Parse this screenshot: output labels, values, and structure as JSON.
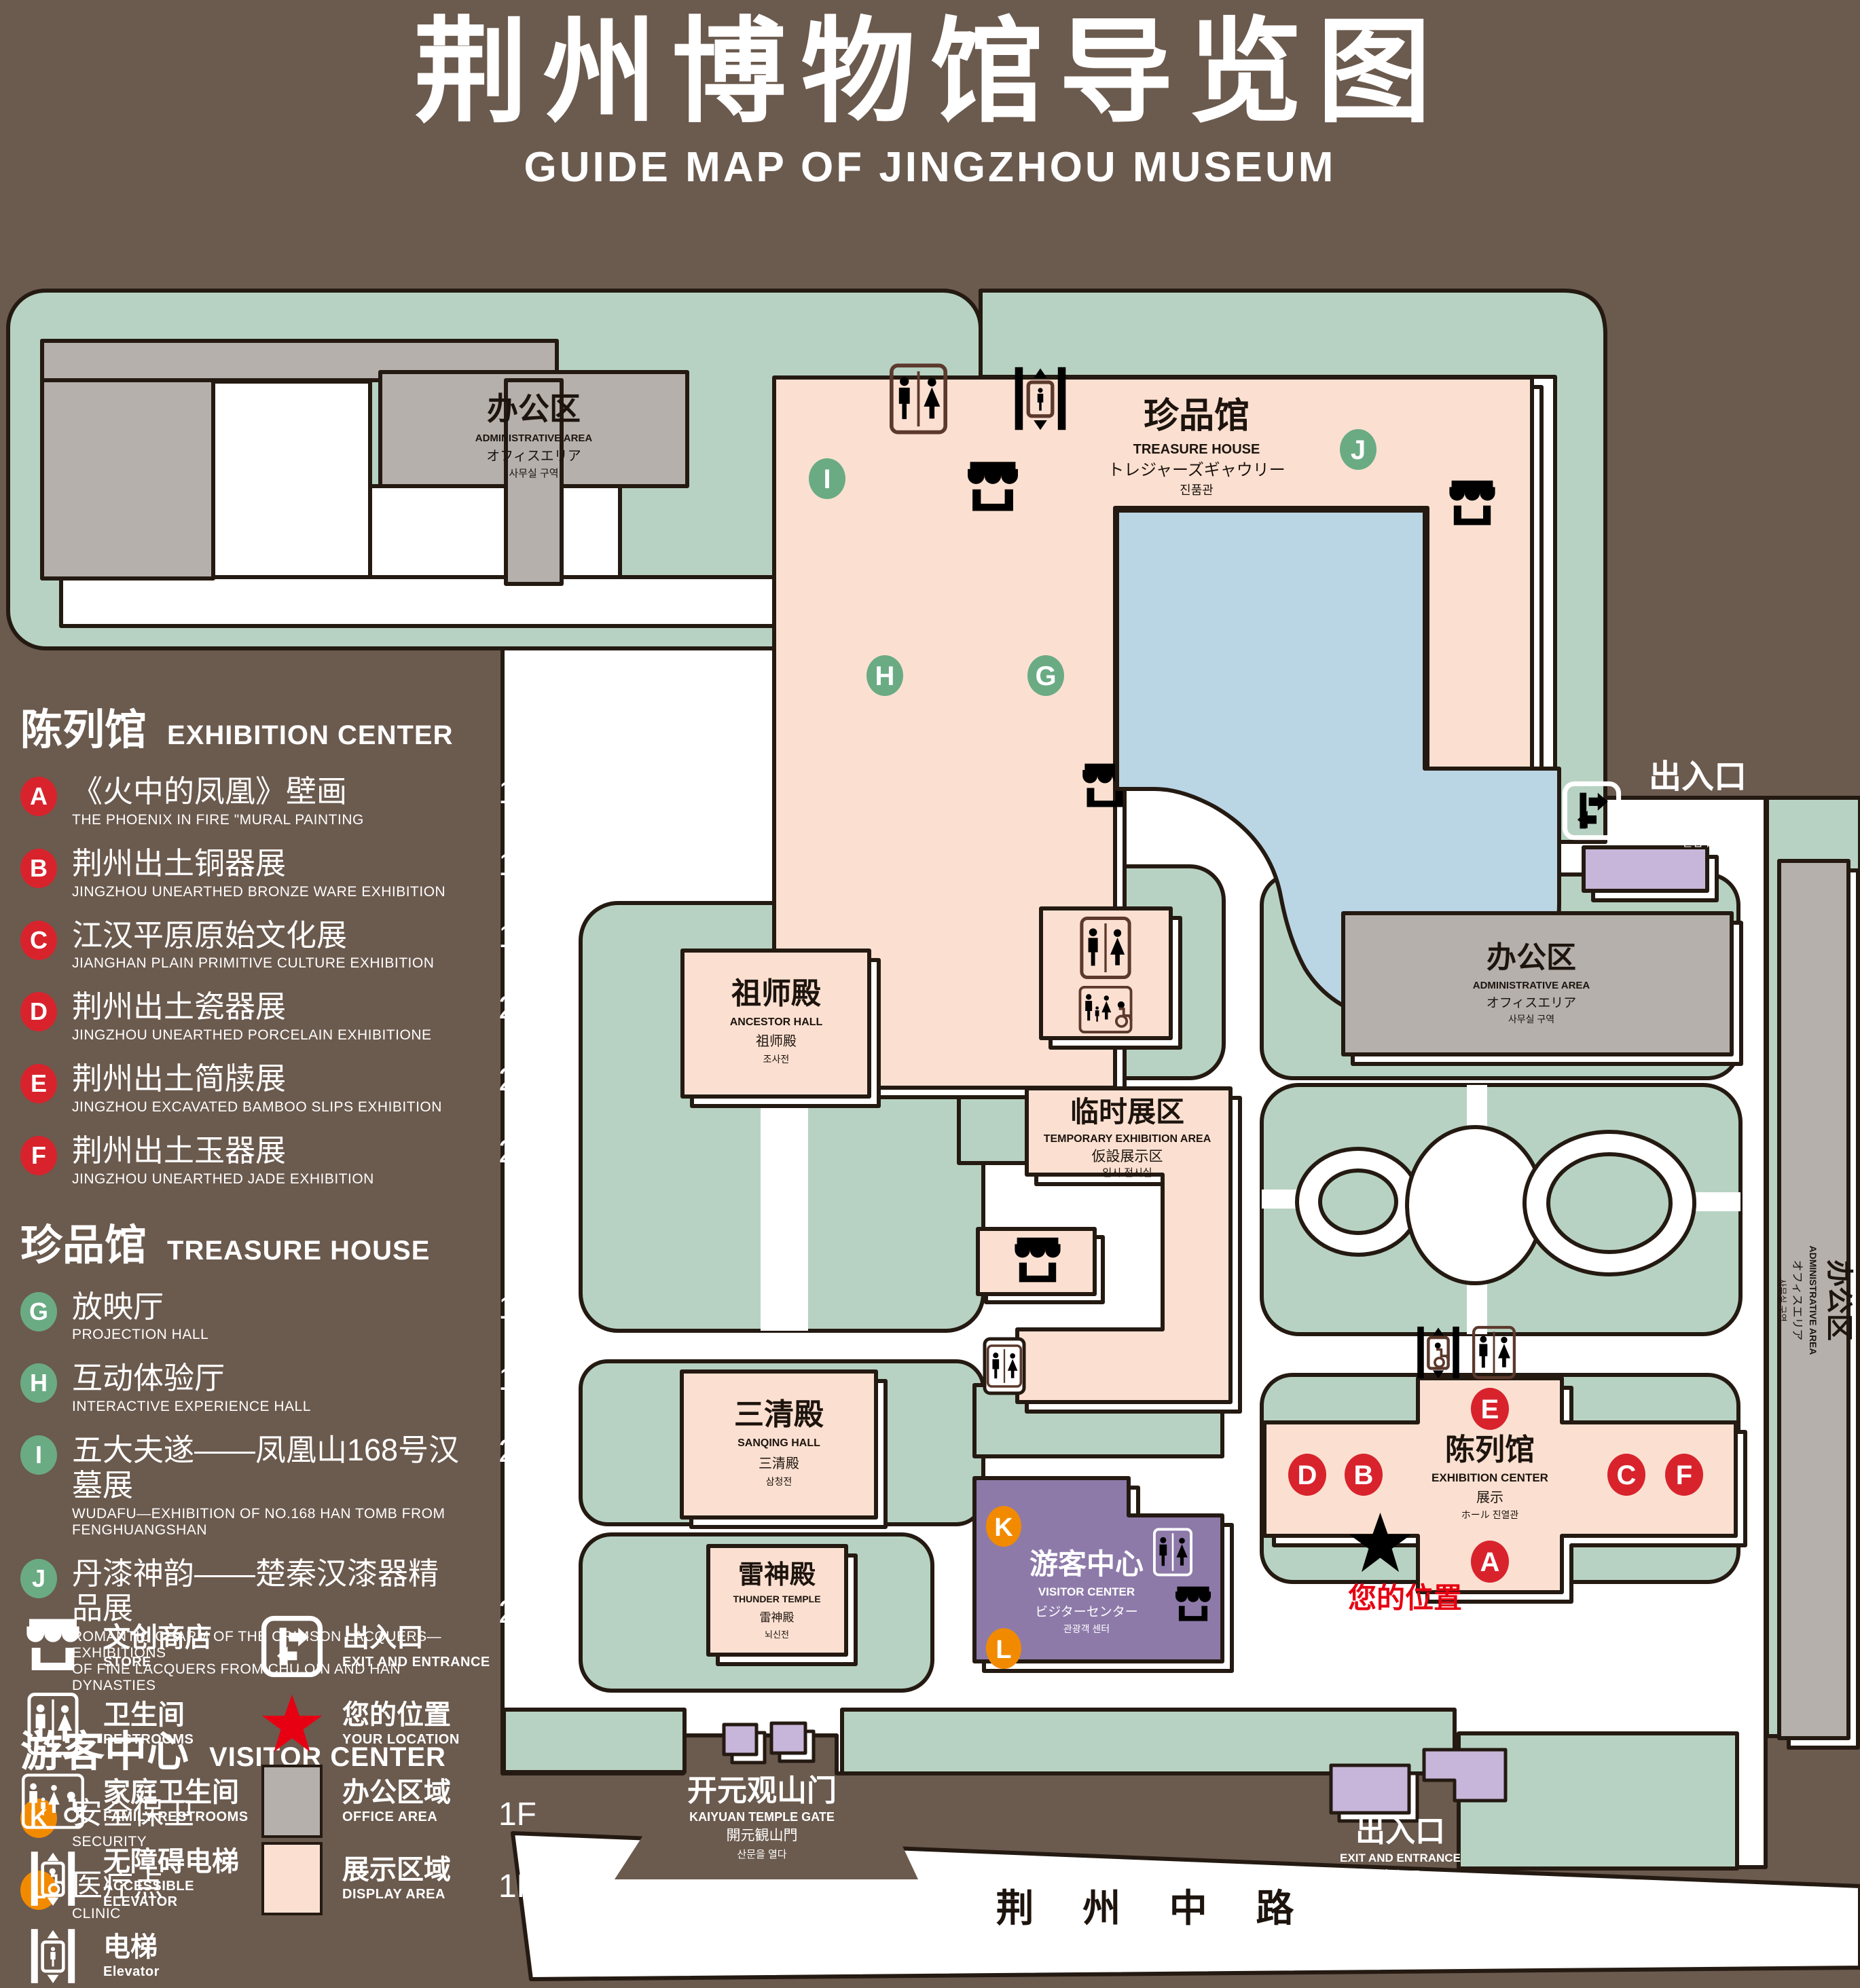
{
  "title": {
    "zh": "荆州博物馆导览图",
    "en": "GUIDE MAP OF JINGZHOU MUSEUM"
  },
  "legend": {
    "sections": [
      {
        "zh": "陈列馆",
        "en": "EXHIBITION CENTER"
      },
      {
        "zh": "珍品馆",
        "en": "TREASURE HOUSE"
      },
      {
        "zh": "游客中心",
        "en": "VISITOR CENTER"
      }
    ],
    "items": [
      {
        "code": "A",
        "zh": "《火中的凤凰》壁画",
        "en": "THE PHOENIX IN FIRE \"MURAL PAINTING",
        "floor": "1F"
      },
      {
        "code": "B",
        "zh": "荆州出土铜器展",
        "en": "JINGZHOU UNEARTHED BRONZE WARE EXHIBITION",
        "floor": "1F"
      },
      {
        "code": "C",
        "zh": "江汉平原原始文化展",
        "en": "JIANGHAN PLAIN PRIMITIVE CULTURE EXHIBITION",
        "floor": "1F"
      },
      {
        "code": "D",
        "zh": "荆州出土瓷器展",
        "en": "JINGZHOU UNEARTHED PORCELAIN EXHIBITIONE",
        "floor": "2F"
      },
      {
        "code": "E",
        "zh": "荆州出土简牍展",
        "en": "JINGZHOU EXCAVATED BAMBOO SLIPS EXHIBITION",
        "floor": "2F"
      },
      {
        "code": "F",
        "zh": "荆州出土玉器展",
        "en": "JINGZHOU UNEARTHED JADE EXHIBITION",
        "floor": "2F"
      },
      {
        "code": "G",
        "zh": "放映厅",
        "en": "PROJECTION HALL",
        "floor": "1F"
      },
      {
        "code": "H",
        "zh": "互动体验厅",
        "en": "INTERACTIVE EXPERIENCE HALL",
        "floor": "1F"
      },
      {
        "code": "I",
        "zh": "五大夫遂——凤凰山168号汉墓展",
        "en": "WUDAFU—EXHIBITION OF NO.168 HAN TOMB FROM FENGHUANGSHAN",
        "floor": "2F"
      },
      {
        "code": "J",
        "zh": "丹漆神韵——楚秦汉漆器精品展",
        "en": "ROMANTIC CHARM OF THE CRIMSON LACQUERS—EXHIBITIONS\nOF FINE LACQUERS FROM CHU,QIN AND HAN DYNASTIES",
        "floor": "1-2F"
      },
      {
        "code": "K",
        "zh": "安全保卫",
        "en": "SECURITY",
        "floor": "1F"
      },
      {
        "code": "L",
        "zh": "医疗点",
        "en": "CLINIC",
        "floor": "1F"
      }
    ],
    "symbols": [
      {
        "zh": "文创商店",
        "en": "STORE"
      },
      {
        "zh": "出入口",
        "en": "EXIT AND ENTRANCE"
      },
      {
        "zh": "卫生间",
        "en": "RESTROOMS"
      },
      {
        "zh": "您的位置",
        "en": "YOUR LOCATION"
      },
      {
        "zh": "家庭卫生间",
        "en": "FAMILY RESTROOMS"
      },
      {
        "zh": "办公区域",
        "en": "OFFICE AREA"
      },
      {
        "zh": "无障碍电梯",
        "en": "ACCESSIBLE ELEVATOR"
      },
      {
        "zh": "展示区域",
        "en": "DISPLAY AREA"
      },
      {
        "zh": "电梯",
        "en": "Elevator"
      }
    ]
  },
  "map": {
    "labels": {
      "admin": {
        "zh": "办公区",
        "en": "ADMINISTRATIVE AREA",
        "jp": "オフィスエリア",
        "kr": "사무실 구역"
      },
      "treasure": {
        "zh": "珍品馆",
        "en": "TREASURE HOUSE",
        "jp": "トレジャーズギャウリー",
        "kr": "진품관"
      },
      "ancestor": {
        "zh": "祖师殿",
        "en": "ANCESTOR HALL",
        "jp": "祖师殿",
        "kr": "조사전"
      },
      "temporary": {
        "zh": "临时展区",
        "en": "TEMPORARY EXHIBITION AREA",
        "jp": "仮設展示区",
        "kr": "임시 전시실"
      },
      "sanqing": {
        "zh": "三清殿",
        "en": "SANQING HALL",
        "jp": "三清殿",
        "kr": "삼청전"
      },
      "thunder": {
        "zh": "雷神殿",
        "en": "THUNDER TEMPLE",
        "jp": "雷神殿",
        "kr": "뇌신전"
      },
      "visitor": {
        "zh": "游客中心",
        "en": "VISITOR CENTER",
        "jp": "ビジターセンター",
        "kr": "관광객 센터"
      },
      "exhibition": {
        "zh": "陈列馆",
        "en": "EXHIBITION CENTER",
        "jp": "展示",
        "kr": "ホール 진열관"
      },
      "exit": {
        "zh": "出入口",
        "en": "EXIT AND ENTRANCE",
        "jp": "出入口",
        "kr": "출입구"
      },
      "gate": {
        "zh": "开元观山门",
        "en": "KAIYUAN TEMPLE GATE",
        "jp": "開元観山門",
        "kr": "산문을 열다"
      },
      "road": "荆 州 中 路",
      "your_location": "您的位置"
    },
    "markers": {
      "a": "A",
      "b": "B",
      "c": "C",
      "d": "D",
      "e": "E",
      "f": "F",
      "g": "G",
      "h": "H",
      "i": "I",
      "j": "J",
      "k": "K",
      "l": "L"
    }
  },
  "colors": {
    "background": "#6b5a4e",
    "campus_green": "#b7d2c2",
    "display_area": "#fbe0d1",
    "office_area": "#b5b0ac",
    "water": "#bad5e4",
    "visitor_center": "#8d7aa9",
    "entrance_purple": "#c7b6da",
    "badge_red": "#d8232d",
    "badge_green": "#6aab84",
    "badge_orange": "#f28a00",
    "icon_brown": "#5c392c",
    "outline": "#241a12",
    "location_red": "#e60012"
  }
}
